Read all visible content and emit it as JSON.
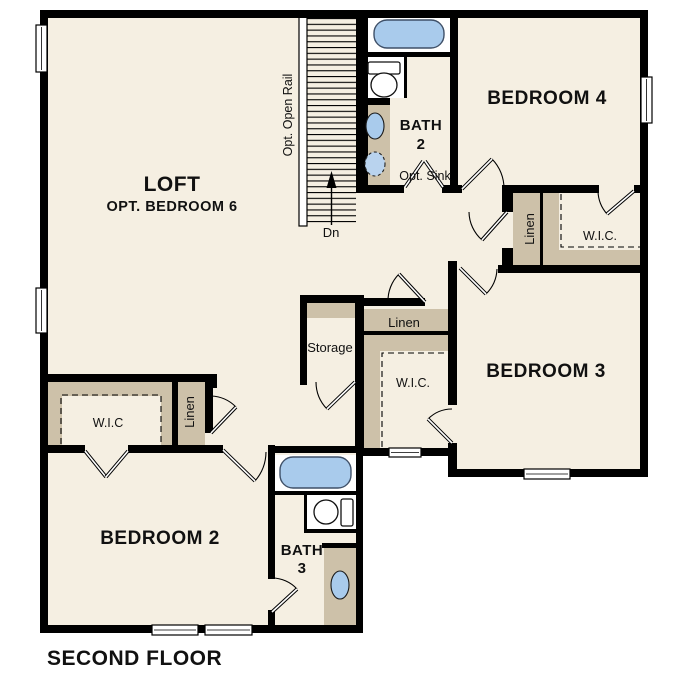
{
  "title": "SECOND FLOOR",
  "colors": {
    "wall": "#000000",
    "floor": "#f5efe2",
    "shelf": "#cdc1a9",
    "fixture_blue": "#a9cbec",
    "window_white": "#ffffff"
  },
  "rooms": {
    "loft": {
      "name": "LOFT",
      "option": "OPT. BEDROOM 6"
    },
    "bedroom4": {
      "name": "BEDROOM 4"
    },
    "bedroom3": {
      "name": "BEDROOM 3"
    },
    "bedroom2": {
      "name": "BEDROOM 2"
    },
    "bath2": {
      "name": "BATH",
      "number": "2",
      "opt_sink": "Opt. Sink"
    },
    "bath3": {
      "name": "BATH",
      "number": "3"
    }
  },
  "closets": {
    "storage": "Storage",
    "hall_linen": "Linen",
    "hall_wic": "W.I.C.",
    "bedroom4_linen": "Linen",
    "bedroom4_wic": "W.I.C.",
    "bedroom2_linen": "Linen",
    "bedroom2_wic": "W.I.C"
  },
  "stairs": {
    "rail": "Opt. Open Rail",
    "direction": "Dn"
  }
}
